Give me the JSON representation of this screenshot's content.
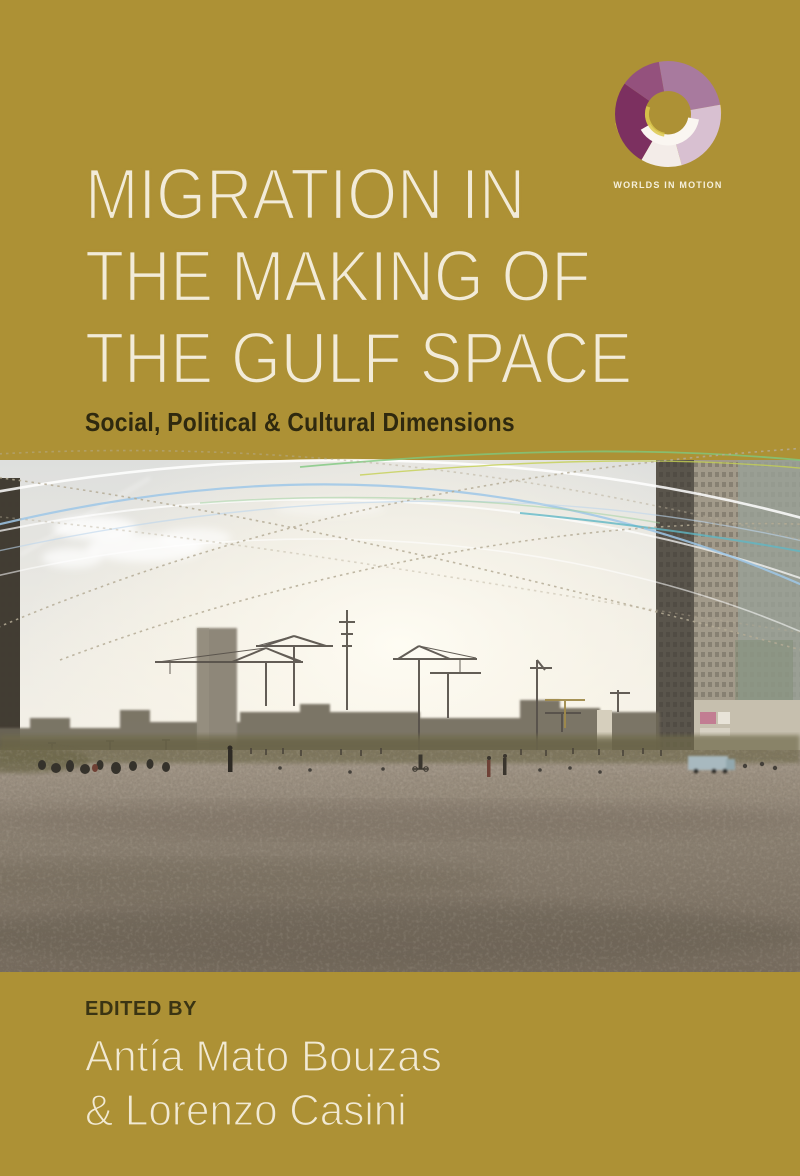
{
  "cover": {
    "series": {
      "logo_label": "WORLDS IN MOTION"
    },
    "title": {
      "lines": [
        "MIGRATION IN",
        "THE MAKING OF",
        "THE GULF SPACE"
      ]
    },
    "subtitle": "Social, Political & Cultural Dimensions",
    "credits": {
      "label": "EDITED BY",
      "editors": [
        "Antía Mato Bouzas",
        "& Lorenzo Casini"
      ]
    },
    "photo": {
      "alt": "Dusty vacant lot with scattered people, construction cranes and high-rise buildings on the horizon under a bright hazy sky"
    },
    "colors": {
      "background_gold": "#ad9135",
      "title_cream": "#f2ebd8",
      "subtitle_dark": "#2f290f",
      "editor_cream": "#f1e9d3",
      "logo_dark_magenta": "#7c3060",
      "logo_mauve": "#a87a9e",
      "logo_pink": "#d8c0d1",
      "logo_yellow": "#e0c63e",
      "arc_blue": "#9ec7e8",
      "arc_teal": "#5fb6c4",
      "arc_green": "#7ec87e"
    }
  }
}
